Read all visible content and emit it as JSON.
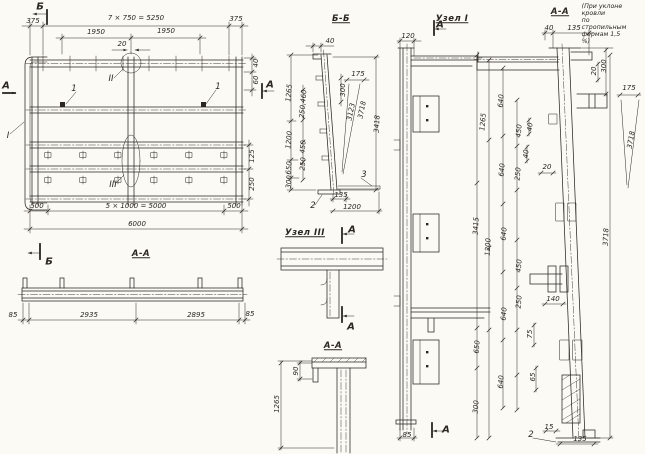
{
  "colors": {
    "paper": "#fbfaf5",
    "ink": "#2a2722"
  },
  "labels": [
    {
      "t": "Б",
      "x": 40,
      "y": 7,
      "c": "marker"
    },
    {
      "t": "375",
      "x": 33,
      "y": 22
    },
    {
      "t": "7 × 750 = 5250",
      "x": 136,
      "y": 19
    },
    {
      "t": "375",
      "x": 236,
      "y": 20
    },
    {
      "t": "1950",
      "x": 96,
      "y": 33
    },
    {
      "t": "1950",
      "x": 166,
      "y": 32
    },
    {
      "t": "20",
      "x": 122,
      "y": 45
    },
    {
      "t": "40",
      "x": 257,
      "y": 63,
      "r": -90
    },
    {
      "t": "60",
      "x": 257,
      "y": 80,
      "r": -90
    },
    {
      "t": "А",
      "x": 270,
      "y": 85,
      "c": "marker"
    },
    {
      "t": "А",
      "x": 6,
      "y": 86,
      "c": "marker"
    },
    {
      "t": "II",
      "x": 111,
      "y": 80,
      "c": "num"
    },
    {
      "t": "1",
      "x": 74,
      "y": 90,
      "c": "num"
    },
    {
      "t": "1",
      "x": 218,
      "y": 88,
      "c": "num"
    },
    {
      "t": "I",
      "x": 8,
      "y": 137,
      "c": "num"
    },
    {
      "t": "III",
      "x": 113,
      "y": 186,
      "c": "num"
    },
    {
      "t": "125",
      "x": 253,
      "y": 156,
      "r": -90
    },
    {
      "t": "250",
      "x": 253,
      "y": 184,
      "r": -90
    },
    {
      "t": "500",
      "x": 37,
      "y": 207
    },
    {
      "t": "5 × 1000 = 5000",
      "x": 136,
      "y": 207
    },
    {
      "t": "500",
      "x": 234,
      "y": 207
    },
    {
      "t": "6000",
      "x": 137,
      "y": 225
    },
    {
      "t": "А-А",
      "x": 141,
      "y": 255,
      "c": "title"
    },
    {
      "t": "Б",
      "x": 49,
      "y": 262,
      "c": "marker"
    },
    {
      "t": "85",
      "x": 13,
      "y": 316
    },
    {
      "t": "2935",
      "x": 89,
      "y": 316
    },
    {
      "t": "2895",
      "x": 196,
      "y": 316
    },
    {
      "t": "85",
      "x": 250,
      "y": 315
    },
    {
      "t": "Б-Б",
      "x": 341,
      "y": 20,
      "c": "title"
    },
    {
      "t": "40",
      "x": 330,
      "y": 42
    },
    {
      "t": "175",
      "x": 358,
      "y": 75
    },
    {
      "t": "300",
      "x": 344,
      "y": 90,
      "r": -90
    },
    {
      "t": "1265",
      "x": 290,
      "y": 93,
      "r": -85
    },
    {
      "t": "250,460",
      "x": 304,
      "y": 104,
      "r": -85
    },
    {
      "t": "3123",
      "x": 352,
      "y": 112,
      "r": -78
    },
    {
      "t": "3718",
      "x": 363,
      "y": 110,
      "r": -78
    },
    {
      "t": "3418",
      "x": 378,
      "y": 124,
      "r": -87
    },
    {
      "t": "1200",
      "x": 290,
      "y": 140,
      "r": -85
    },
    {
      "t": "450",
      "x": 304,
      "y": 147,
      "r": -85
    },
    {
      "t": "250",
      "x": 304,
      "y": 164,
      "r": -85
    },
    {
      "t": "650",
      "x": 290,
      "y": 168,
      "r": -85
    },
    {
      "t": "300",
      "x": 290,
      "y": 182,
      "r": -85
    },
    {
      "t": "135",
      "x": 341,
      "y": 196
    },
    {
      "t": "1200",
      "x": 352,
      "y": 208
    },
    {
      "t": "2",
      "x": 313,
      "y": 207,
      "c": "num"
    },
    {
      "t": "3",
      "x": 364,
      "y": 176,
      "c": "num"
    },
    {
      "t": "Узел III",
      "x": 305,
      "y": 234,
      "c": "title"
    },
    {
      "t": "А",
      "x": 352,
      "y": 230,
      "c": "marker"
    },
    {
      "t": "А",
      "x": 351,
      "y": 327,
      "c": "marker"
    },
    {
      "t": "А-А",
      "x": 333,
      "y": 347,
      "c": "title"
    },
    {
      "t": "90",
      "x": 297,
      "y": 371,
      "r": -90
    },
    {
      "t": "1265",
      "x": 278,
      "y": 404,
      "r": -90
    },
    {
      "t": "Узел I",
      "x": 452,
      "y": 20,
      "c": "title"
    },
    {
      "t": "А",
      "x": 440,
      "y": 25,
      "c": "marker"
    },
    {
      "t": "120",
      "x": 408,
      "y": 37
    },
    {
      "t": "85",
      "x": 407,
      "y": 436
    },
    {
      "t": "А",
      "x": 446,
      "y": 430,
      "c": "marker"
    },
    {
      "t": "А-А",
      "x": 560,
      "y": 13,
      "c": "title"
    },
    {
      "t": "(При уклоне кровли\nпо стропильным\nфермам 1,5 %)",
      "x": 604,
      "y": 24,
      "c": "note"
    },
    {
      "t": "40",
      "x": 549,
      "y": 29
    },
    {
      "t": "135",
      "x": 574,
      "y": 29
    },
    {
      "t": "20",
      "x": 595,
      "y": 71,
      "r": -90
    },
    {
      "t": "300",
      "x": 605,
      "y": 66,
      "r": -90
    },
    {
      "t": "175",
      "x": 629,
      "y": 89
    },
    {
      "t": "3718",
      "x": 632,
      "y": 140,
      "r": -80
    },
    {
      "t": "1265",
      "x": 484,
      "y": 122,
      "r": -85
    },
    {
      "t": "640",
      "x": 502,
      "y": 101,
      "r": -85
    },
    {
      "t": "450",
      "x": 520,
      "y": 131,
      "r": -85
    },
    {
      "t": "40",
      "x": 531,
      "y": 127,
      "r": -85
    },
    {
      "t": "40",
      "x": 527,
      "y": 154,
      "r": -85
    },
    {
      "t": "250",
      "x": 519,
      "y": 174,
      "r": -85
    },
    {
      "t": "640",
      "x": 503,
      "y": 170,
      "r": -85
    },
    {
      "t": "20",
      "x": 547,
      "y": 168
    },
    {
      "t": "3415",
      "x": 477,
      "y": 226,
      "r": -87
    },
    {
      "t": "1200",
      "x": 489,
      "y": 247,
      "r": -87
    },
    {
      "t": "640",
      "x": 505,
      "y": 234,
      "r": -85
    },
    {
      "t": "450",
      "x": 520,
      "y": 266,
      "r": -85
    },
    {
      "t": "250",
      "x": 520,
      "y": 302,
      "r": -85
    },
    {
      "t": "640",
      "x": 505,
      "y": 314,
      "r": -85
    },
    {
      "t": "140",
      "x": 553,
      "y": 300
    },
    {
      "t": "75",
      "x": 531,
      "y": 334,
      "r": -90
    },
    {
      "t": "650",
      "x": 478,
      "y": 347,
      "r": -85
    },
    {
      "t": "640",
      "x": 502,
      "y": 382,
      "r": -85
    },
    {
      "t": "300",
      "x": 477,
      "y": 407,
      "r": -85
    },
    {
      "t": "65",
      "x": 534,
      "y": 377,
      "r": -90
    },
    {
      "t": "3718",
      "x": 607,
      "y": 237,
      "r": -88
    },
    {
      "t": "15",
      "x": 549,
      "y": 428
    },
    {
      "t": "135",
      "x": 580,
      "y": 440
    },
    {
      "t": "2",
      "x": 531,
      "y": 436,
      "c": "num"
    }
  ]
}
